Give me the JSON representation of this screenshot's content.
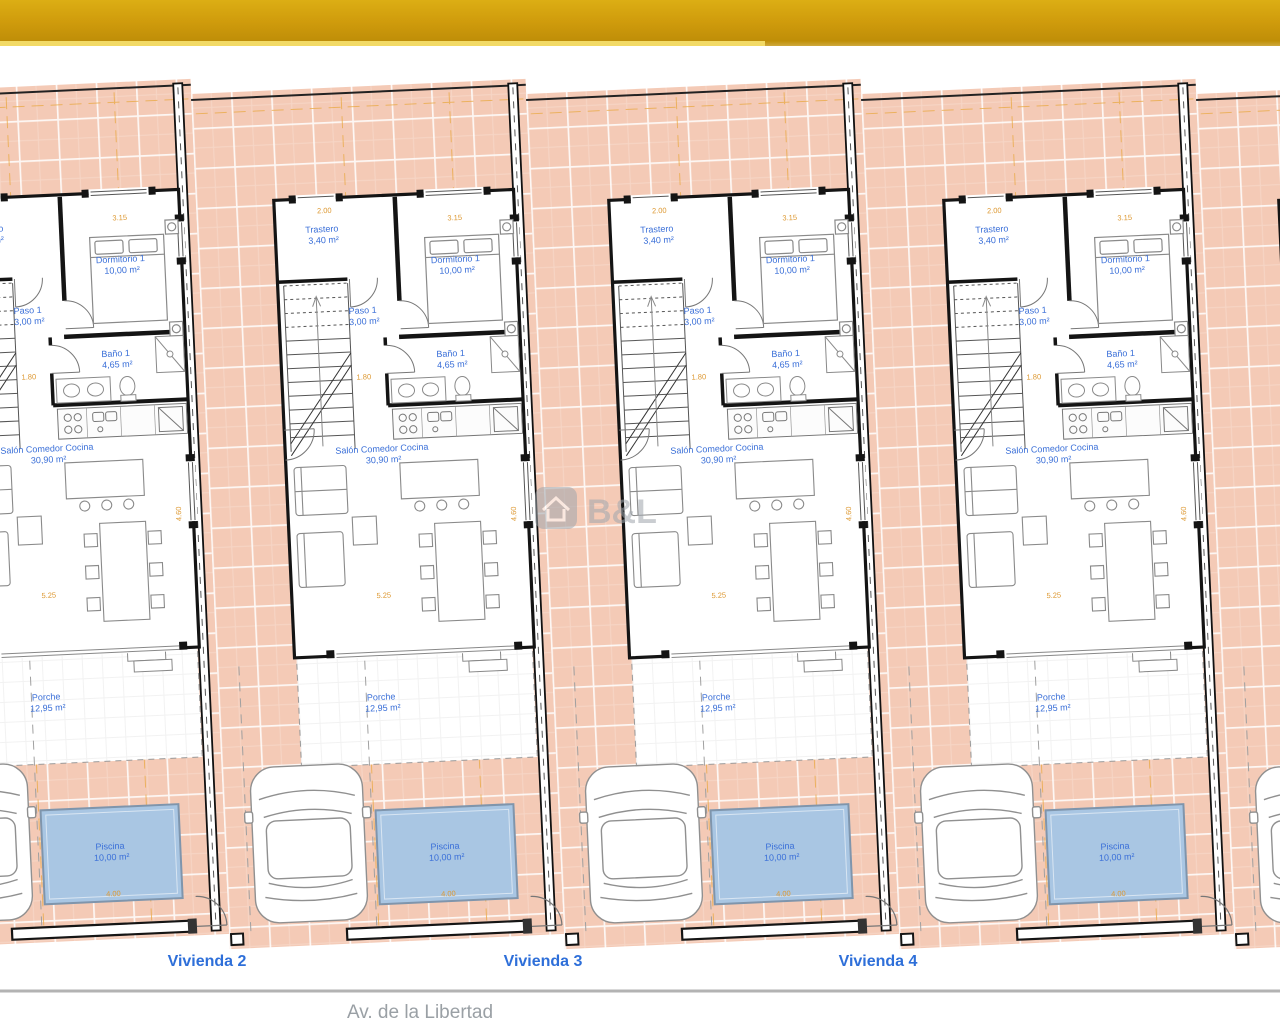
{
  "plan": {
    "units": [
      {
        "label": "Vivienda 2"
      },
      {
        "label": "Vivienda 3"
      },
      {
        "label": "Vivienda 4"
      }
    ],
    "rooms": {
      "trastero": {
        "name": "Trastero",
        "area": "3,40 m²"
      },
      "dormitorio": {
        "name": "Dormitorio 1",
        "area": "10,00 m²"
      },
      "paso": {
        "name": "Paso 1",
        "area": "3,00 m²"
      },
      "bano": {
        "name": "Baño 1",
        "area": "4,65 m²"
      },
      "salon": {
        "name": "Salón Comedor Cocina",
        "area": "30,90 m²"
      },
      "porche": {
        "name": "Porche",
        "area": "12,95 m²"
      },
      "piscina": {
        "name": "Piscina",
        "area": "10,00 m²"
      }
    },
    "dimensions": {
      "trastero_width": "2.00",
      "dorm_width": "3.15",
      "paso_width": "1.80",
      "salon_width": "5.25",
      "salon_height": "4.60",
      "pool_width": "4.00"
    },
    "street_label": "Av. de la Libertad",
    "watermark": "B&L",
    "colors": {
      "top_bar_gold": "#cf9b0c",
      "top_bar_strip": "#f2da66",
      "tile_salmon": "#f4cab6",
      "pool_blue": "#a9c6e3",
      "room_label_blue": "#3a6fd8",
      "unit_label_blue": "#2e6fd9",
      "dimension_orange": "#dd9933",
      "street_gray": "#9aa0a5",
      "wall_black": "#141414"
    }
  }
}
